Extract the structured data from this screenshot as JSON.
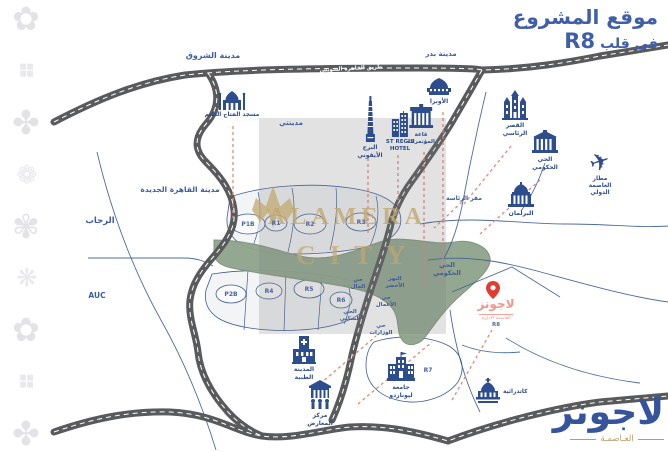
{
  "title": {
    "line1": "موقع المشروع",
    "line2_text": "فى قلب",
    "line2_highlight": "R8"
  },
  "watermark": {
    "brand": "ALAMERA",
    "word": "CITY"
  },
  "brand_logo": {
    "name": "لاجونز",
    "tagline": "العـاصمـة"
  },
  "project": {
    "name": "لاجونز",
    "sub": "العاصمة الادارية",
    "district": "R8"
  },
  "glyphs": {
    "plane": "✈"
  },
  "decor": {
    "tiles": [
      "✿",
      "❖",
      "✤",
      "❁",
      "✾",
      "❋",
      "✿",
      "❖",
      "✤"
    ]
  },
  "road_label": "طريق القاهرة السويس",
  "cities": [
    {
      "label": "مدينة الشروق"
    },
    {
      "label": "مدينة بدر"
    },
    {
      "label": "مدينتي"
    },
    {
      "label": "مدينة القاهرة الجديدة"
    },
    {
      "label": "الرحاب"
    },
    {
      "label": "AUC"
    }
  ],
  "districts": [
    {
      "label": "P1B"
    },
    {
      "label": "R1"
    },
    {
      "label": "R2"
    },
    {
      "label": "R3"
    },
    {
      "label": "P2B"
    },
    {
      "label": "R4"
    },
    {
      "label": "R5"
    },
    {
      "label": "R6"
    },
    {
      "label": "R7"
    }
  ],
  "areas": [
    {
      "label": "حي\nالمال"
    },
    {
      "label": "النهر\nالأخضر"
    },
    {
      "label": "حي\nالأعمال"
    },
    {
      "label": "الحي\nالسكني"
    },
    {
      "label": "حي\nالوزارات"
    },
    {
      "label": "الحي\nالحكومي"
    },
    {
      "label": "مقر الرئاسة"
    }
  ],
  "landmarks": [
    {
      "label": "مسجد الفتاح العليم"
    },
    {
      "label": "البرج\nالأيقوني"
    },
    {
      "label": "ST REGIS\nHOTEL"
    },
    {
      "label": "قاعة\nالمؤتمرات"
    },
    {
      "label": "الأوبرا"
    },
    {
      "label": "القصر\nالرئاسي"
    },
    {
      "label": "الحي\nالحكومي"
    },
    {
      "label": "مطار\nالعاصمة\nالدولي"
    },
    {
      "label": "البرلمان"
    },
    {
      "label": "المدينة\nالطبية"
    },
    {
      "label": "مركز\nالمعارض"
    },
    {
      "label": "جامعة\nليوناردو"
    },
    {
      "label": "كاتدرائية"
    }
  ],
  "colors": {
    "primary_blue": "#2d4d8c",
    "title_blue": "#3f5fa8",
    "road_gray": "#595a5c",
    "green_river": "#8fa48c",
    "leader_red": "#df8a7d",
    "pin_red": "#e23b30",
    "logo_salmon": "#f0958b",
    "gold": "#bc9c64"
  }
}
